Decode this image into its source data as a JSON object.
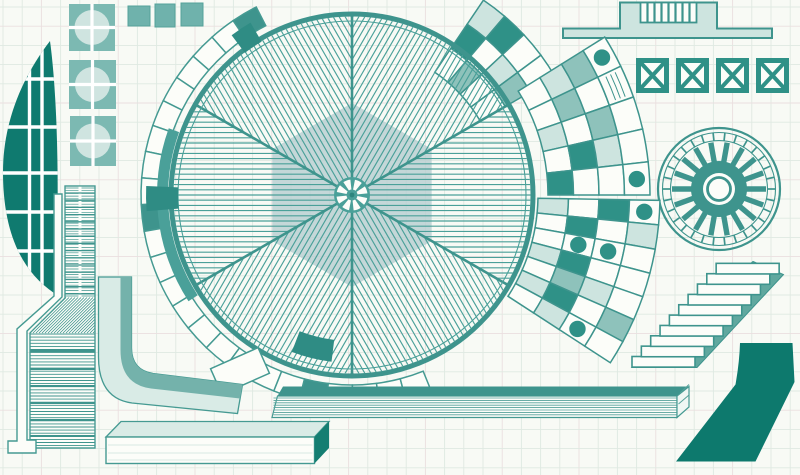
{
  "artwork": {
    "description": "hand-drawn abstract architectural illustration, teal ink on graph paper",
    "palette": {
      "paper": "#f8faf5",
      "grid_line": "#dfe9e2",
      "grid_line_alt": "#eadfdf",
      "stroke": "#459a92",
      "hatch": "#4aa099",
      "divider": "#3e948d",
      "dark_fill": "#0d796d",
      "leaf_fill": "#0f7a6f",
      "solid_cell": "#2f9187",
      "medium_wash": "#8ec2bb",
      "light_wash": "#cde4df",
      "pale_wash": "#d9ebe6",
      "white_fill": "#fcfdf9",
      "hexagon": "#b7ced1",
      "stringer": "#60a89f",
      "porthole_square": "#7cb9b2",
      "porthole_circle": "#cfe4e0",
      "shadow_wash": "#74b2ab",
      "end_cap_dark": "#147e72"
    },
    "graph_paper": {
      "spacing": 19.2,
      "offset_x": 3,
      "offset_y": 7,
      "alt_every": 4
    },
    "leaf": {
      "path": "M50,41 C20,80 3,125 3,172 C3,230 20,270 54,293 C59,245 60,115 50,41 Z",
      "vertical_lines": [
        29.5,
        42
      ],
      "horizontal_lines": [
        79,
        127,
        173,
        212,
        251
      ],
      "line_width": 3.4
    },
    "portholes": {
      "squares": [
        {
          "x": 69,
          "y": 4,
          "w": 46,
          "h": 47
        },
        {
          "x": 69,
          "y": 60,
          "w": 47,
          "h": 49
        },
        {
          "x": 70,
          "y": 116,
          "w": 46,
          "h": 50
        }
      ],
      "circle_radius": 17.5,
      "cross_width": 3.2
    },
    "top_squares": [
      {
        "x": 128,
        "y": 6,
        "w": 22,
        "h": 20
      },
      {
        "x": 155,
        "y": 4,
        "w": 20,
        "h": 23
      },
      {
        "x": 181,
        "y": 3,
        "w": 22,
        "h": 23
      }
    ],
    "big_wheel": {
      "cx": 352,
      "cy": 195,
      "radius": 181,
      "inner_ring_radius": 174,
      "sectors": 6,
      "first_boundary_deg": 90,
      "hatch_spacing": 5.2,
      "hatch_clip_radius": 178.5,
      "hexagon_radius": 92,
      "hub": {
        "radius": 18,
        "blades": 8,
        "blade_r0": 5.5,
        "blade_r1": 15.5,
        "center_dot": 2.4
      }
    },
    "arc_band": {
      "r_inner": 190,
      "r_outer": 211,
      "angle_start": 117,
      "angle_end": 292,
      "segments": 24,
      "solid_segments": [
        0,
        9,
        19
      ],
      "thick_arc": {
        "r0": 184,
        "r1": 195,
        "a0": 160,
        "a1": 213
      },
      "overlay_blocks": [
        {
          "r0": 174,
          "r1": 206,
          "a0": 177.5,
          "a1": 184.5
        },
        {
          "r0": 178,
          "r1": 200,
          "a0": 120.5,
          "a1": 127
        },
        {
          "r0": 146,
          "r1": 168,
          "a0": 249,
          "a1": 263
        }
      ]
    },
    "fans": [
      {
        "name": "fan-top",
        "r0": 148,
        "r1": 235,
        "a0": 30,
        "a1": 56,
        "radial": 3,
        "cells": [
          [
            "w",
            "d",
            "l"
          ],
          [
            "m",
            "w",
            "d"
          ],
          [
            "w",
            "l",
            "w"
          ],
          [
            "w",
            "m",
            "w"
          ]
        ]
      },
      {
        "name": "fan-middle",
        "r0": 196,
        "r1": 298,
        "a0": 0,
        "a1": 32,
        "radial": 4,
        "cells": [
          [
            "w",
            "l",
            "m",
            "c"
          ],
          [
            "w",
            "m",
            "w",
            "h"
          ],
          [
            "l",
            "w",
            "m",
            "w"
          ],
          [
            "w",
            "d",
            "l",
            "w"
          ],
          [
            "d",
            "w",
            "w",
            "c"
          ]
        ]
      },
      {
        "name": "fan-bottom",
        "r0": 186,
        "r1": 308,
        "a0": -33,
        "a1": -1,
        "radial": 4,
        "cells": [
          [
            "l",
            "w",
            "d",
            "c"
          ],
          [
            "w",
            "d",
            "w",
            "l"
          ],
          [
            "w",
            "c",
            "c",
            "w"
          ],
          [
            "l",
            "d",
            "w",
            "w"
          ],
          [
            "w",
            "m",
            "l",
            "w"
          ],
          [
            "l",
            "d",
            "w",
            "m"
          ],
          [
            "w",
            "l",
            "c",
            "w"
          ]
        ]
      }
    ],
    "turbine": {
      "cx": 719,
      "cy": 189,
      "outer_radius": 61,
      "ring_radius": 56.5,
      "tick_inner": 48.5,
      "ticks": 30,
      "spokes": 18,
      "spoke_r0": 26,
      "spoke_r1": 47,
      "spoke_width": 5.4,
      "disc_radius": 28,
      "hole_radius": 16,
      "eye_radius": 11.5
    },
    "podium": {
      "path": "M563,38 L563,28.5 L620,28.5 L620,2.5 L717,2.5 L717,28.5 L772,28.5 L772,38 Z",
      "comb": {
        "x": 640.5,
        "y": 2.5,
        "w": 56,
        "h": 20,
        "bars": 7
      }
    },
    "x_squares": {
      "count": 4,
      "x0": 636,
      "step": 40,
      "y": 58,
      "w": 33,
      "h": 35,
      "inset": 5
    },
    "stairs": {
      "steps": 10,
      "x0": 632,
      "y0": 356.5,
      "dx": 9.35,
      "dy": 10.35,
      "tread_w": 63,
      "tread_h": 10.6,
      "stringer_points": "632,367.5 753,261.5 783.5,274.5 697,367.5"
    },
    "dark_ribbon": {
      "path": "M740,343 L792.5,343 L794.5,382 L755.5,461.5 L676,461.5 L735.5,384.5 Q739.5,362 740,343 Z"
    },
    "beam_long": {
      "top": "M283,386.5 L689,386.5 L689,396 L277.5,396 Z",
      "front": "M277.5,396 L677,396 L677,417.5 L272,417.5 Z",
      "cap": "M677,396 L689,386.5 L689,407 L677,417.5 Z",
      "hatch_y0": 398,
      "hatch_y1": 416.5,
      "hatch_step": 2.4,
      "hatch_x0": 273.5,
      "hatch_x1": 676.5
    },
    "beam_front": {
      "top": "M106,437 L121,421.5 L329,421.5 L314.5,437 Z",
      "front": {
        "x": 106,
        "y": 437,
        "w": 208.5,
        "h": 26.5
      },
      "side": "M314.5,437 L329,421.5 L329,448 L314.5,463.5 Z",
      "front_lines": [
        445,
        453,
        460
      ]
    },
    "l_ribbon": {
      "tip": {
        "x": 214,
        "y": 357,
        "w": 52,
        "h": 28,
        "rotate": -24,
        "rcx": 240,
        "rcy": 371
      },
      "light": "M98.5,277 L131.5,277 L131.5,348 Q131.5,370 153,373.5 L242.5,384.5 L237.5,413.5 L132,403 Q98.5,398.5 98.5,357 Z",
      "shadow": "M120.5,277 L131.5,277 L131.5,348 Q131.5,370 153,373.5 L242.5,384.5 L240,398.5 L151,388.5 Q120.5,384.5 120.5,350 Z"
    },
    "funnel": {
      "outline_col": "M54,194 L62,194 L62,297 L27,331 L27,440 L36,440 L36,453 L8,453 L8,441 L17,441 L17,329 L54,296 Z",
      "body": "M65,186 L95,186 L95,448 L30,448 L30,333 L65,298 Z",
      "top_fine_step": 2.7,
      "top_div_step": 7.2,
      "gap_x": 78.5,
      "low_step": 3.1,
      "low_dividers": [
        351,
        369,
        386,
        403,
        420,
        436
      ]
    }
  }
}
